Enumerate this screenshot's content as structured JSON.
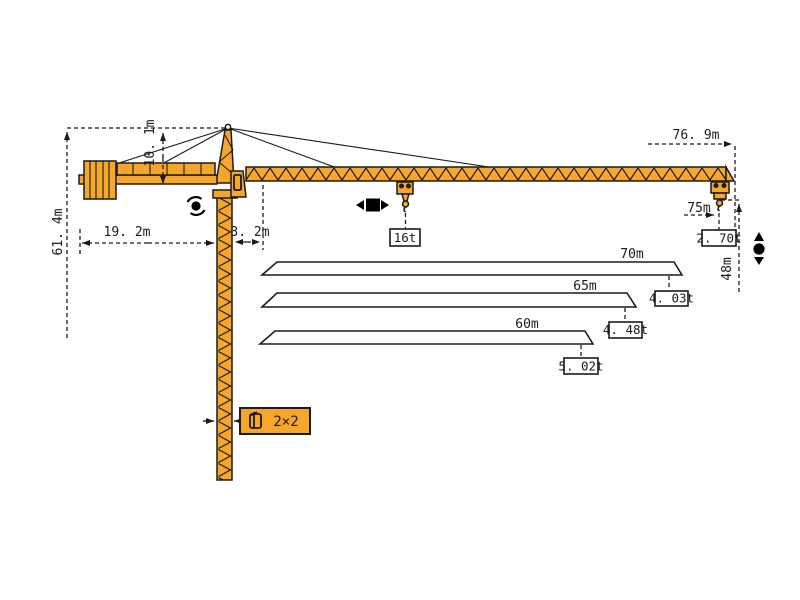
{
  "diagram": {
    "type": "tower-crane-dimension-diagram",
    "colors": {
      "crane_orange": "#F6A62B",
      "outline_black": "#1b1b1b",
      "paper": "#ffffff"
    },
    "dimensions": {
      "total_height": "61. 4m",
      "tower_head_height": "10. 1m",
      "counter_jib_radius": "19. 2m",
      "slew_offset": "3. 2m",
      "jib_overall_length": "76. 9m",
      "max_working_radius": "75m",
      "tip_hook_height": "48m",
      "mast_cross_section": "2×2"
    },
    "loads": {
      "max_load": "16t",
      "tip_load_full_jib": "2. 70t"
    },
    "jib_options": [
      {
        "length": "70m",
        "tip_load": "4. 03t"
      },
      {
        "length": "65m",
        "tip_load": "4. 48t"
      },
      {
        "length": "60m",
        "tip_load": "5. 02t"
      }
    ],
    "icons": {
      "slewing": "rotation-icon",
      "trolley_travel": "left-right-arrow-icon",
      "hoisting": "up-down-arrow-icon"
    }
  },
  "chart_data": {
    "type": "table",
    "title": "Jib length vs tip load",
    "categories": [
      "76.9m jib @75m radius",
      "70m jib",
      "65m jib",
      "60m jib"
    ],
    "values": [
      2.7,
      4.03,
      4.48,
      5.02
    ],
    "xlabel": "jib length",
    "ylabel": "tip load (t)",
    "max_load_t": 16
  }
}
